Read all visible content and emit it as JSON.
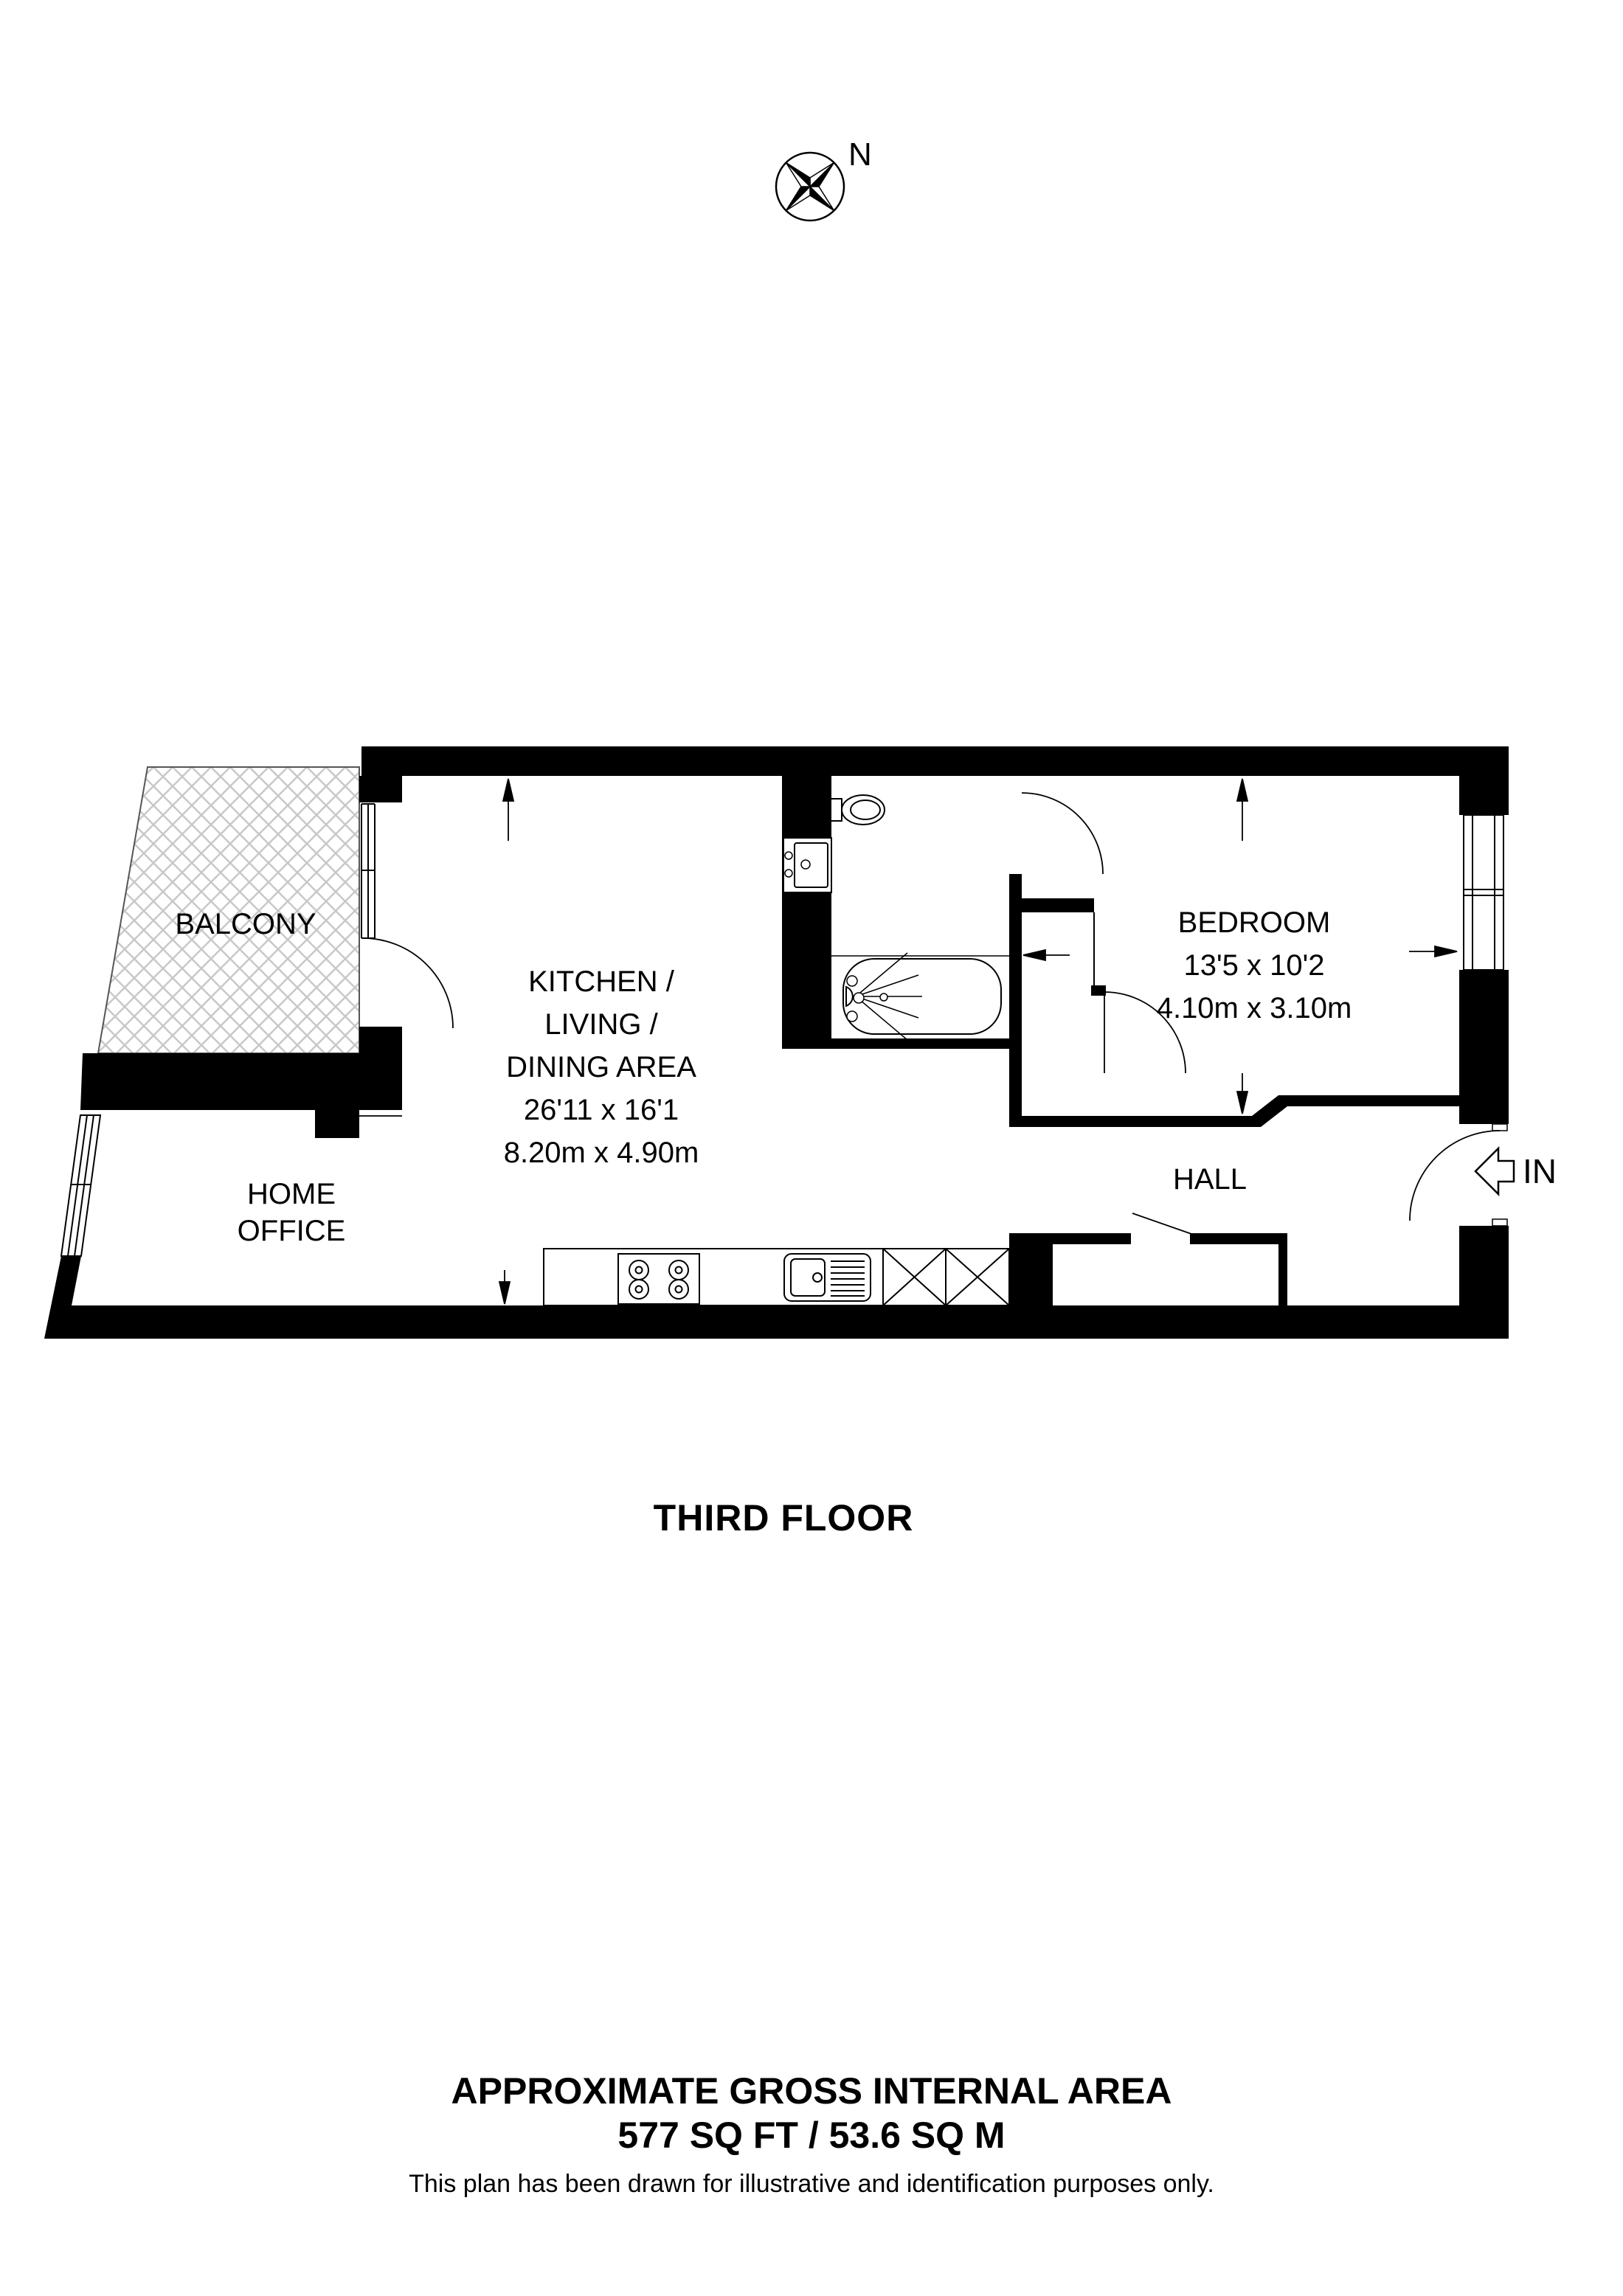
{
  "page": {
    "background": "#ffffff",
    "ink": "#000000",
    "hatch_color": "#c8c8c8"
  },
  "compass": {
    "north": "N"
  },
  "plan": {
    "floor": "THIRD FLOOR",
    "entrance_label": "IN",
    "rooms": {
      "balcony": {
        "label": "BALCONY"
      },
      "kitchen_living_dining": {
        "lines": [
          "KITCHEN /",
          "LIVING /",
          "DINING AREA"
        ],
        "imperial": "26'11 x 16'1",
        "metric": "8.20m x 4.90m"
      },
      "bedroom": {
        "label": "BEDROOM",
        "imperial": "13'5 x 10'2",
        "metric": "4.10m x 3.10m"
      },
      "hall": {
        "label": "HALL"
      },
      "home_office": {
        "lines": [
          "HOME",
          "OFFICE"
        ]
      }
    }
  },
  "footer": {
    "title": "APPROXIMATE GROSS INTERNAL AREA",
    "area": "577 SQ FT / 53.6 SQ M",
    "disclaimer": "This plan has been drawn for illustrative and identification purposes only."
  }
}
